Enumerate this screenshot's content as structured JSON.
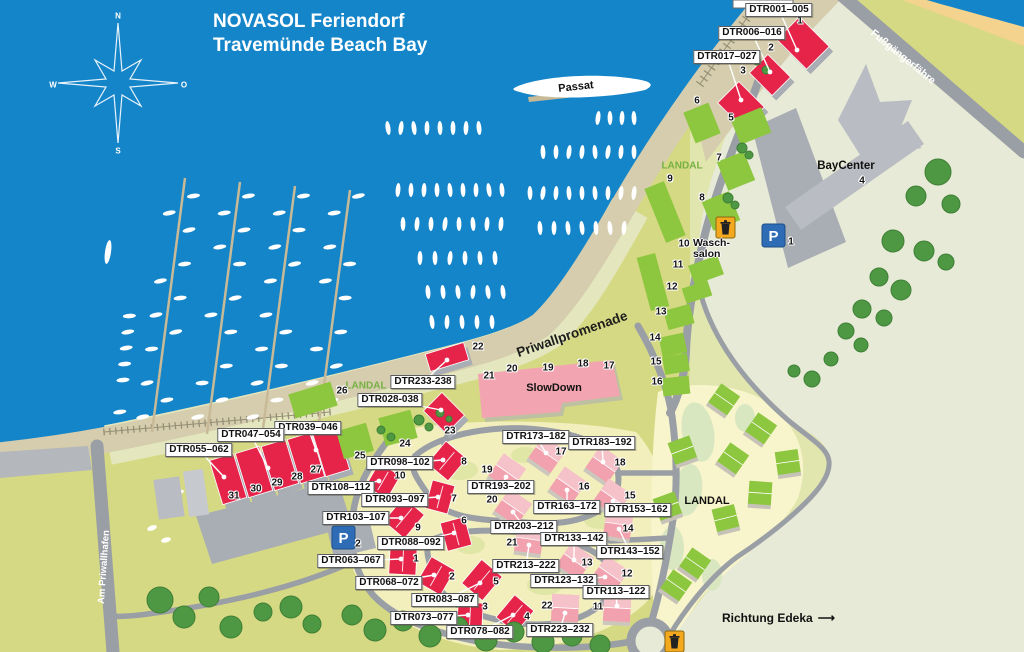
{
  "title": {
    "brand": "NOVASOL",
    "suffix": " Feriendorf",
    "line2": "Travemünde Beach Bay"
  },
  "compass": {
    "n": "N",
    "o": "O",
    "s": "S",
    "w": "W"
  },
  "ship": {
    "name": "Passat"
  },
  "streets": {
    "promenade": "Priwallpromenade",
    "ferry": "Fußgängerfähre",
    "harbor": "Am Priwallhafen",
    "direction": "Richtung Edeka",
    "arrow": "⟶"
  },
  "areas": {
    "baycenter": "BayCenter",
    "slowdown": "SlowDown",
    "laundry1": "Wasch-",
    "laundry2": "salon",
    "landal": "LANDAL"
  },
  "icons": {
    "parking": "P"
  },
  "colors": {
    "water": "#1585C9",
    "land": "#D6D983",
    "sand": "#F3D38D",
    "building_red": "#E6244A",
    "building_pink": "#F1A2AE",
    "building_green": "#8DC63F",
    "building_gray": "#B9BCC2",
    "road": "#9A9EA5",
    "tree": "#4E9843"
  },
  "labels": [
    {
      "text": "DTR001–005",
      "x": 779,
      "y": 10,
      "tx": 797,
      "ty": 50
    },
    {
      "text": "DTR006–016",
      "x": 752,
      "y": 33,
      "tx": 770,
      "ty": 72
    },
    {
      "text": "DTR017–027",
      "x": 727,
      "y": 57,
      "tx": 741,
      "ty": 100
    },
    {
      "text": "DTR233-238",
      "x": 423,
      "y": 382,
      "tx": 447,
      "ty": 360
    },
    {
      "text": "DTR028-038",
      "x": 390,
      "y": 400,
      "tx": 441,
      "ty": 410
    },
    {
      "text": "DTR039–046",
      "x": 308,
      "y": 428,
      "tx": 316,
      "ty": 450
    },
    {
      "text": "DTR047–054",
      "x": 251,
      "y": 435,
      "tx": 268,
      "ty": 468
    },
    {
      "text": "DTR055–062",
      "x": 199,
      "y": 450,
      "tx": 224,
      "ty": 477
    },
    {
      "text": "DTR098–102",
      "x": 400,
      "y": 463,
      "tx": 443,
      "ty": 460
    },
    {
      "text": "DTR108–112",
      "x": 341,
      "y": 488,
      "tx": 379,
      "ty": 481
    },
    {
      "text": "DTR093–097",
      "x": 395,
      "y": 500,
      "tx": 438,
      "ty": 497
    },
    {
      "text": "DTR103–107",
      "x": 356,
      "y": 518,
      "tx": 401,
      "ty": 518
    },
    {
      "text": "DTR088–092",
      "x": 411,
      "y": 543,
      "tx": 454,
      "ty": 533
    },
    {
      "text": "DTR063–067",
      "x": 351,
      "y": 561,
      "tx": 401,
      "ty": 559
    },
    {
      "text": "DTR068–072",
      "x": 389,
      "y": 583,
      "tx": 434,
      "ty": 575
    },
    {
      "text": "DTR083–087",
      "x": 445,
      "y": 600,
      "tx": 480,
      "ty": 583
    },
    {
      "text": "DTR073–077",
      "x": 424,
      "y": 618,
      "tx": 468,
      "ty": 615
    },
    {
      "text": "DTR078–082",
      "x": 480,
      "y": 632,
      "tx": 513,
      "ty": 615
    },
    {
      "text": "DTR173–182",
      "x": 536,
      "y": 437,
      "tx": 546,
      "ty": 453
    },
    {
      "text": "DTR183–192",
      "x": 602,
      "y": 443,
      "tx": 603,
      "ty": 462
    },
    {
      "text": "DTR193–202",
      "x": 501,
      "y": 487,
      "tx": 506,
      "ty": 477
    },
    {
      "text": "DTR163–172",
      "x": 567,
      "y": 507,
      "tx": 567,
      "ty": 490
    },
    {
      "text": "DTR153–162",
      "x": 638,
      "y": 510,
      "tx": 613,
      "ty": 501
    },
    {
      "text": "DTR203–212",
      "x": 524,
      "y": 527,
      "tx": 513,
      "ty": 512
    },
    {
      "text": "DTR133–142",
      "x": 574,
      "y": 539,
      "tx": 574,
      "ty": 560
    },
    {
      "text": "DTR143–152",
      "x": 630,
      "y": 552,
      "tx": 619,
      "ty": 529
    },
    {
      "text": "DTR213–222",
      "x": 526,
      "y": 566,
      "tx": 529,
      "ty": 545
    },
    {
      "text": "DTR123–132",
      "x": 564,
      "y": 581,
      "tx": 605,
      "ty": 577
    },
    {
      "text": "DTR113–122",
      "x": 616,
      "y": 592,
      "tx": 617,
      "ty": 606
    },
    {
      "text": "DTR223–232",
      "x": 560,
      "y": 630,
      "tx": 565,
      "ty": 613
    }
  ],
  "numbers": [
    [
      1,
      800,
      21
    ],
    [
      2,
      771,
      48
    ],
    [
      3,
      743,
      71
    ],
    [
      6,
      697,
      101
    ],
    [
      5,
      731,
      118
    ],
    [
      7,
      719,
      158
    ],
    [
      8,
      702,
      198
    ],
    [
      9,
      670,
      179
    ],
    [
      10,
      684,
      244
    ],
    [
      11,
      678,
      265
    ],
    [
      12,
      672,
      287
    ],
    [
      13,
      661,
      312
    ],
    [
      14,
      655,
      338
    ],
    [
      15,
      656,
      362
    ],
    [
      16,
      657,
      382
    ],
    [
      4,
      862,
      181
    ],
    [
      22,
      478,
      347
    ],
    [
      21,
      489,
      376
    ],
    [
      20,
      512,
      369
    ],
    [
      19,
      548,
      368
    ],
    [
      18,
      583,
      364
    ],
    [
      17,
      609,
      366
    ],
    [
      26,
      342,
      391
    ],
    [
      23,
      450,
      431
    ],
    [
      24,
      405,
      444
    ],
    [
      25,
      360,
      456
    ],
    [
      31,
      234,
      496
    ],
    [
      30,
      256,
      489
    ],
    [
      29,
      277,
      483
    ],
    [
      28,
      297,
      477
    ],
    [
      27,
      316,
      470
    ],
    [
      8,
      464,
      462
    ],
    [
      10,
      400,
      476
    ],
    [
      7,
      454,
      499
    ],
    [
      9,
      418,
      528
    ],
    [
      6,
      464,
      521
    ],
    [
      1,
      416,
      559
    ],
    [
      2,
      452,
      577
    ],
    [
      5,
      496,
      582
    ],
    [
      3,
      485,
      607
    ],
    [
      4,
      527,
      617
    ],
    [
      17,
      561,
      452
    ],
    [
      18,
      620,
      463
    ],
    [
      19,
      487,
      470
    ],
    [
      16,
      584,
      487
    ],
    [
      15,
      630,
      496
    ],
    [
      20,
      492,
      500
    ],
    [
      14,
      628,
      529
    ],
    [
      21,
      512,
      543
    ],
    [
      13,
      587,
      563
    ],
    [
      12,
      627,
      574
    ],
    [
      22,
      547,
      606
    ],
    [
      11,
      598,
      607
    ],
    [
      1,
      791,
      242
    ],
    [
      2,
      358,
      544
    ]
  ]
}
